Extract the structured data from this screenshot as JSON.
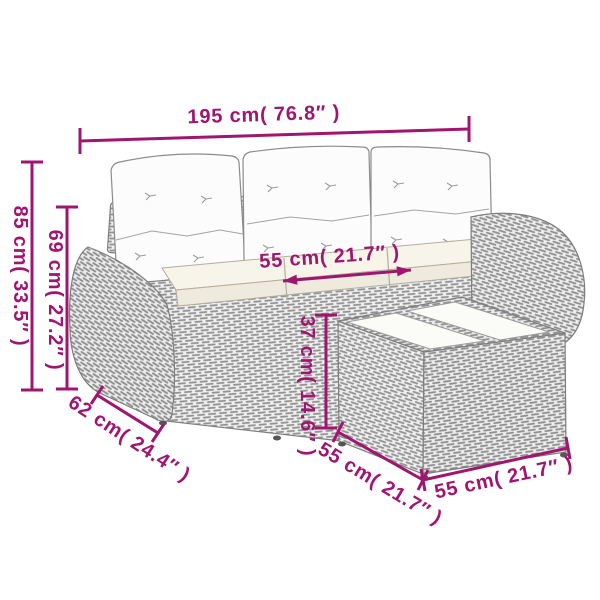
{
  "diagram": {
    "accent": "#A0156F",
    "labels": {
      "total_width": "195 cm( 76.8″ )",
      "total_height": "85 cm( 33.5″ )",
      "back_height": "69 cm( 27.2″ )",
      "seat_depth": "55 cm( 21.7″ )",
      "stool_height": "37 cm( 14.6″ )",
      "arm_depth": "62 cm( 24.4″ )",
      "stool_depth": "55 cm( 21.7″ )",
      "stool_width": "55 cm( 21.7″ )"
    }
  }
}
